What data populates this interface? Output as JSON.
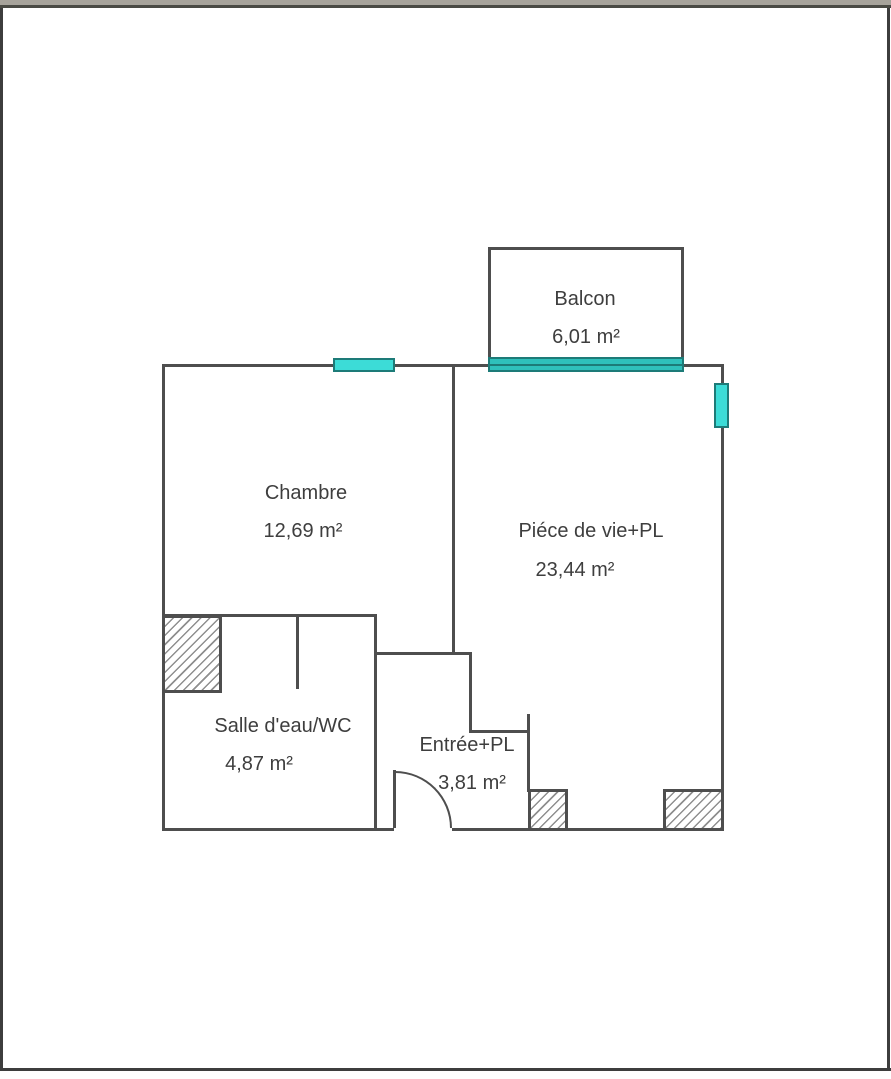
{
  "window_chrome": {
    "top_bar_color": "#a7a39b",
    "top_bar_line_color": "#4a4a44",
    "page_border_color": "#3d3d3d",
    "page_background": "#ffffff"
  },
  "plan": {
    "type": "floor-plan",
    "wall_color": "#4e4e4e",
    "glass_color": "#3cdcd7",
    "slider_glass_color": "#2fc0bb",
    "glass_border_color": "#1d7b78",
    "hatch_line_color": "#8f8f8f",
    "text_color": "#3e3e3e",
    "rooms": {
      "balcon": {
        "label": "Balcon",
        "area": "6,01 m²"
      },
      "chambre": {
        "label": "Chambre",
        "area": "12,69 m²"
      },
      "piece_de_vie": {
        "label": "Piéce de vie+PL",
        "area": "23,44 m²"
      },
      "salle_eau_wc": {
        "label": "Salle d'eau/WC",
        "area": "4,87 m²"
      },
      "entree": {
        "label": "Entrée+PL",
        "area": "3,81 m²"
      }
    }
  }
}
